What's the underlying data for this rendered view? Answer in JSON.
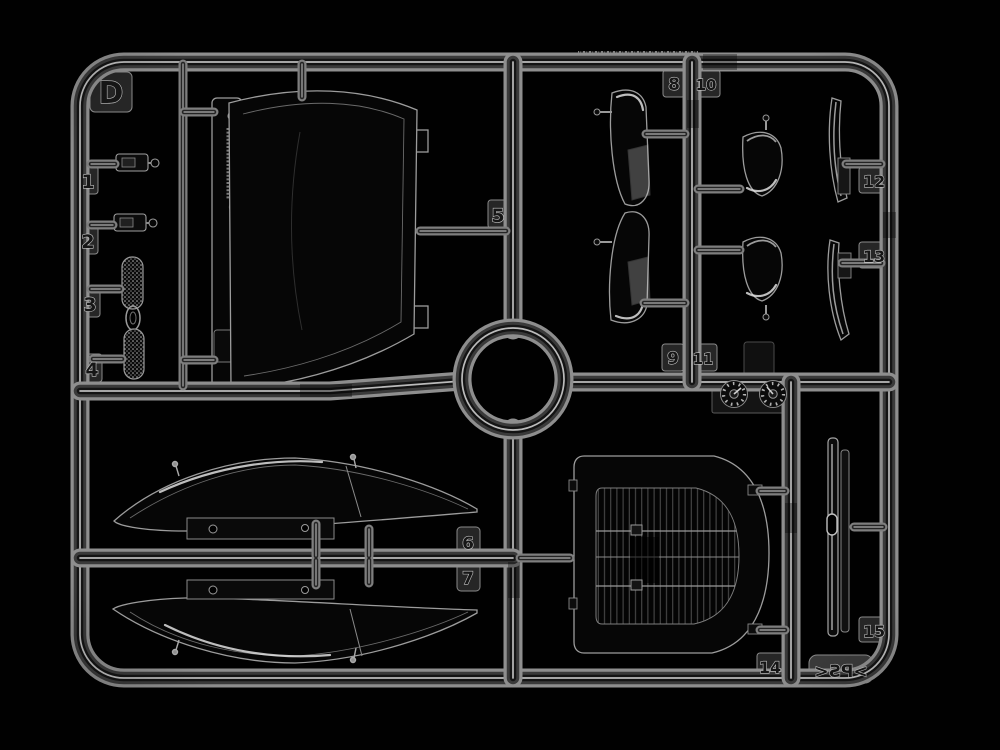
{
  "colors": {
    "background": "#000000",
    "runner_light": "#8e8e8e",
    "runner_highlight": "#d8d8d8",
    "runner_core_dark": "#141414",
    "tab_plate": "#262626",
    "label_emboss": "#c2c2c2"
  },
  "sprue": {
    "plate_letter": "D",
    "material_mark": ">PS<",
    "tabs": [
      {
        "label": "1"
      },
      {
        "label": "2"
      },
      {
        "label": "3"
      },
      {
        "label": "4"
      },
      {
        "label": "5"
      },
      {
        "label": "6"
      },
      {
        "label": "7"
      },
      {
        "label": "8"
      },
      {
        "label": "9"
      },
      {
        "label": "10"
      },
      {
        "label": "11"
      },
      {
        "label": "12"
      },
      {
        "label": "13"
      },
      {
        "label": "14"
      },
      {
        "label": "15"
      }
    ],
    "icons": {
      "date_wheels": "mold-date-wheel-icon"
    }
  }
}
